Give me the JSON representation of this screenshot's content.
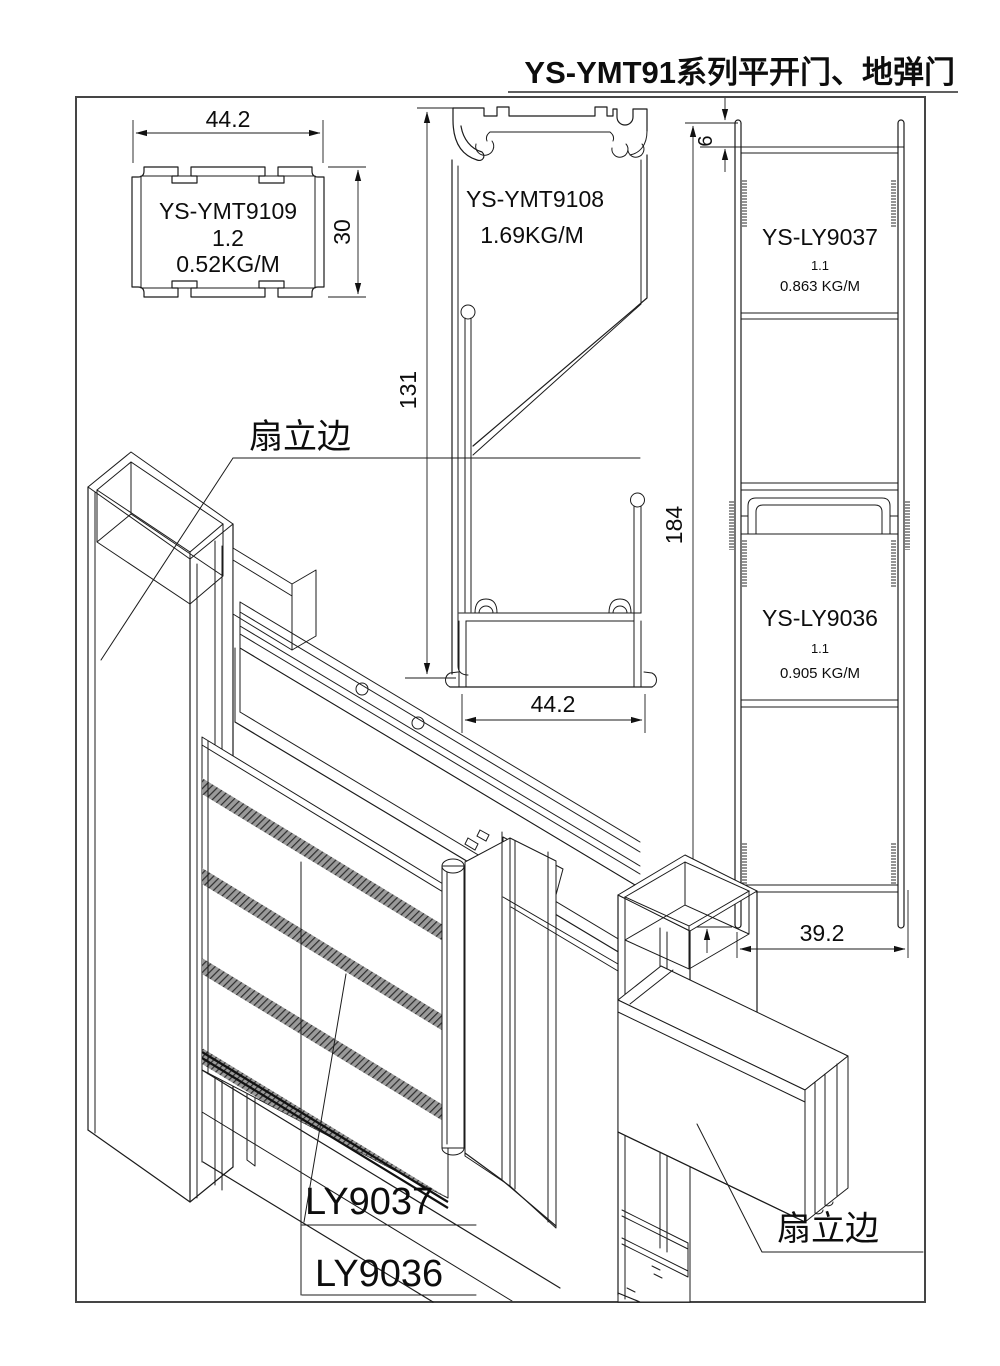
{
  "title": "YS-YMT91系列平开门、地弹门",
  "profiles": {
    "ymt9109": {
      "name": "YS-YMT9109",
      "thickness": "1.2",
      "weight": "0.52KG/M",
      "width": "44.2",
      "height": "30"
    },
    "ymt9108": {
      "name": "YS-YMT9108",
      "weight": "1.69KG/M",
      "height": "131",
      "width": "44.2"
    },
    "ly9037": {
      "name": "YS-LY9037",
      "thickness": "1.1",
      "weight": "0.863 KG/M"
    },
    "ly9036": {
      "name": "YS-LY9036",
      "thickness": "1.1",
      "weight": "0.905 KG/M"
    },
    "ly_dims": {
      "top_flange": "6",
      "height": "184",
      "bottom_leg": "8",
      "width": "39.2"
    }
  },
  "assembly": {
    "label_sash_left": "扇立边",
    "label_sash_right": "扇立边",
    "label_ly9037": "LY9037",
    "label_ly9036": "LY9036"
  }
}
